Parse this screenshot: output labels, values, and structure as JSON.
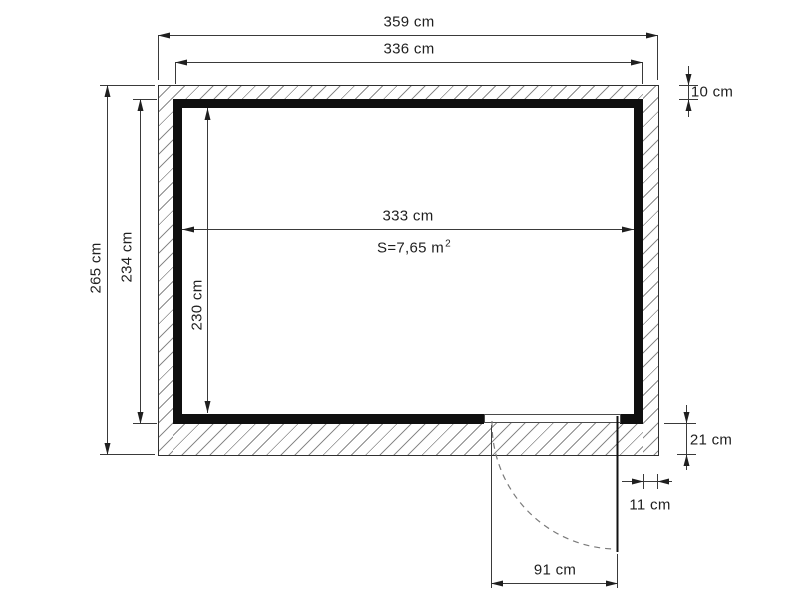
{
  "plan": {
    "type_label": "shed-floor-plan",
    "dims": {
      "outer_width": "359 cm",
      "frame_width": "336 cm",
      "interior_width": "333 cm",
      "outer_height": "265 cm",
      "frame_height": "234 cm",
      "interior_height": "230 cm",
      "top_wall": "10 cm",
      "bottom_wall": "21 cm",
      "side_wall": "11 cm",
      "door_width": "91 cm"
    },
    "area": {
      "value": "S=7,65 m",
      "exponent": "2"
    },
    "colors": {
      "wall_fill": "#0f0f0f",
      "line": "#3a3a3a",
      "hatch": "#8a8a8a",
      "background": "#ffffff"
    }
  }
}
